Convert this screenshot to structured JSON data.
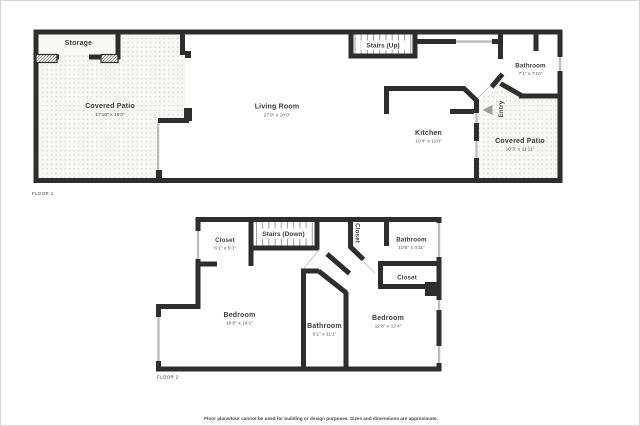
{
  "page": {
    "floor1_label": "FLOOR 1",
    "floor2_label": "FLOOR 2",
    "disclaimer": "Floor plans/tour cannot be used for building or design purposes. Sizes and dimensions are approximate."
  },
  "colors": {
    "wall": "#2e2e2e",
    "window": "#bdbdbd",
    "patio_dot": "#dcdcda",
    "patio_bg": "#f6f6f5",
    "arrow": "#9e9e9e"
  },
  "floor1": {
    "storage": {
      "name": "Storage"
    },
    "covered_patio_left": {
      "name": "Covered Patio",
      "dims": "17'10\" x 18'0\""
    },
    "living_room": {
      "name": "Living Room",
      "dims": "27'0\" x 18'0\""
    },
    "stairs": {
      "name": "Stairs (Up)"
    },
    "kitchen": {
      "name": "Kitchen",
      "dims": "10'4\" x 11'0\""
    },
    "bathroom": {
      "name": "Bathroom",
      "dims": "7'1\" x 7'10\""
    },
    "covered_patio_right": {
      "name": "Covered Patio",
      "dims": "10'3\" x 11'11\""
    },
    "entry": {
      "name": "Entry"
    }
  },
  "floor2": {
    "closet_top_left": {
      "name": "Closet",
      "dims": "6'1\" x 5'3\""
    },
    "stairs": {
      "name": "Stairs (Down)"
    },
    "closet_hall": {
      "name": "Closet"
    },
    "bathroom_top": {
      "name": "Bathroom",
      "dims": "10'5\" x 4'11\""
    },
    "closet_right": {
      "name": "Closet"
    },
    "bedroom_left": {
      "name": "Bedroom",
      "dims": "16'6\" x 14'1\""
    },
    "bathroom_middle": {
      "name": "Bathroom",
      "dims": "5'1\" x 11'1\""
    },
    "bedroom_right": {
      "name": "Bedroom",
      "dims": "12'8\" x 12'4\""
    }
  }
}
